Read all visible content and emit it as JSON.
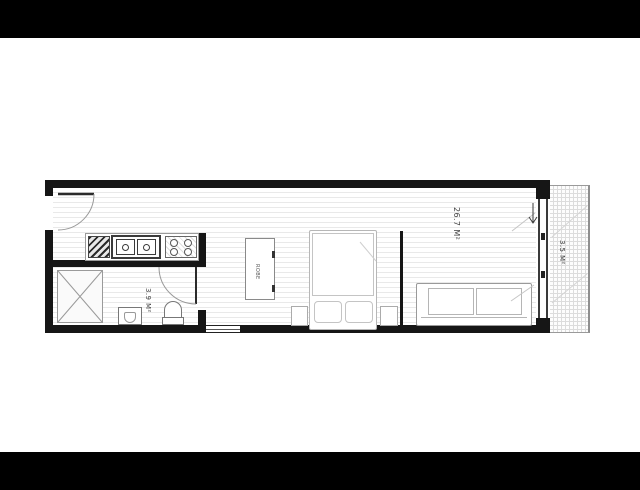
{
  "floorplan": {
    "labels": {
      "living": "26.7 M²",
      "bathroom": "3.9 M²",
      "balcony": "3.5 M²",
      "wardrobe": "ROBE"
    },
    "colors": {
      "matte": "#000000",
      "paper": "#ffffff",
      "wall": "#161616",
      "fixture_stroke": "#8f8f8f",
      "floor_stripe": "#e9e9e9",
      "balcony_grid": "#dcdcdc",
      "label_text": "#3f3f3f"
    },
    "areas_m2": {
      "living": 26.7,
      "bathroom": 3.9,
      "balcony": 3.5
    }
  }
}
